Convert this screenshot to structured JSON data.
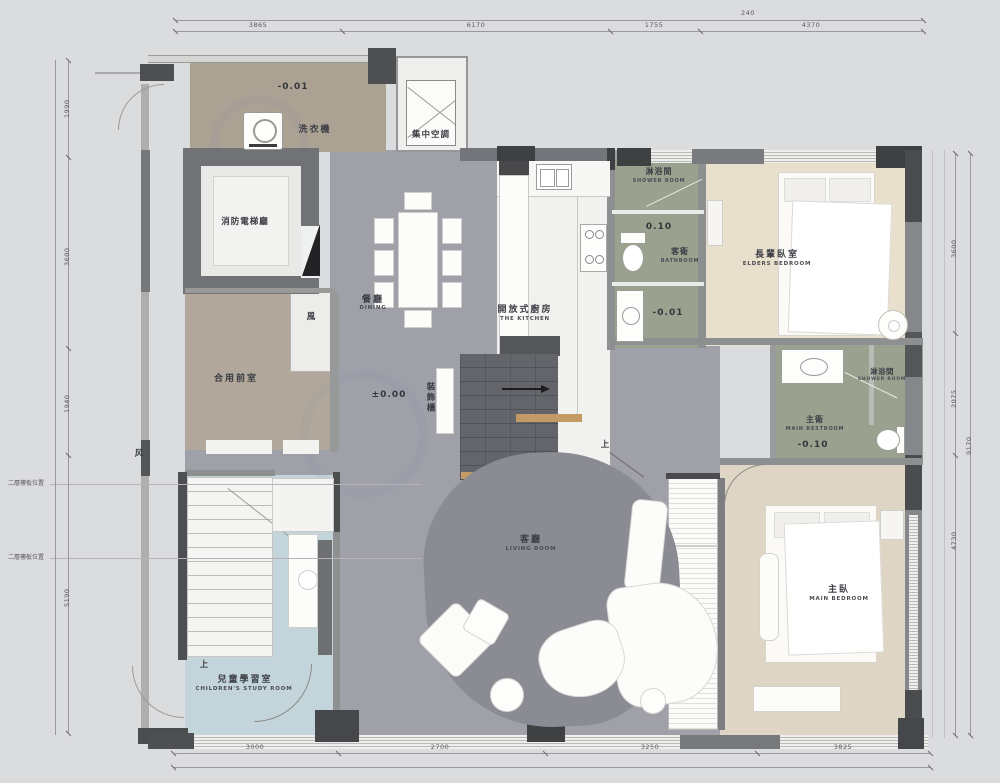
{
  "rooms": {
    "laundry": {
      "appliance": "洗衣機",
      "elevation": "-0.01"
    },
    "central_ac": {
      "zh": "集中空調"
    },
    "elevator_hall": {
      "zh": "消防電梯廳"
    },
    "vestibule": {
      "zh": "合用前室"
    },
    "dining": {
      "zh": "餐廳",
      "en": "DINING",
      "elevation": "±0.00"
    },
    "kitchen": {
      "zh": "開放式廚房",
      "en": "THE KITCHEN"
    },
    "decor_cabinet": {
      "zh": "裝飾櫃"
    },
    "guest_shower": {
      "zh": "淋浴間",
      "en": "SHOWER ROOM",
      "elevation": "0.10"
    },
    "guest_bath": {
      "zh": "客衛",
      "en": "BATHROOM",
      "elevation": "-0.01"
    },
    "elders_bedroom": {
      "zh": "長輩臥室",
      "en": "ELDERS BEDROOM"
    },
    "main_bath": {
      "zh": "主衛",
      "en": "MAIN RESTROOM",
      "elevation": "-0.10"
    },
    "main_shower": {
      "zh": "淋浴間",
      "en": "SHOWER ROOM"
    },
    "main_bedroom": {
      "zh": "主臥",
      "en": "MAIN BEDROOM"
    },
    "living": {
      "zh": "客廳",
      "en": "LIVING ROOM"
    },
    "children": {
      "zh": "兒童學習室",
      "en": "CHILDREN'S STUDY ROOM",
      "up": "上"
    }
  },
  "stairs": {
    "up": "上"
  },
  "notes": {
    "wind": "風",
    "wind_simplified": "风",
    "slab_position": "二層樓板位置"
  },
  "dimensions": {
    "top": {
      "total": "240",
      "segments": [
        "3865",
        "6170",
        "1755",
        "4370"
      ]
    },
    "bottom": {
      "segments": [
        "3000",
        "2700",
        "3250",
        "3825"
      ]
    },
    "left": {
      "segments": [
        "1990",
        "3600",
        "1940",
        "5190"
      ]
    },
    "right": {
      "total": "9170",
      "segments": [
        "3600",
        "2075",
        "4730"
      ]
    }
  },
  "colors": {
    "floor_gray": "#9fa0a8",
    "floor_rug": "#8a8b93",
    "floor_tan": "#b0a799",
    "floor_cream": "#e8dfcd",
    "floor_cream_dark": "#ded5c4",
    "floor_olive": "#9aa18e",
    "floor_blue": "#c3d5da",
    "wall_dark": "#424346",
    "wall_mid": "#77787b",
    "wood": "#c49a66"
  }
}
